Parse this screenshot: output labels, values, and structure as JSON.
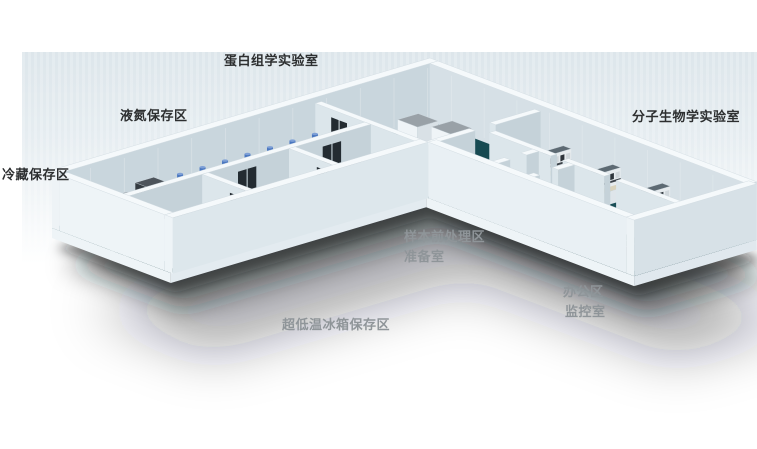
{
  "labels": {
    "proteomics_lab": "蛋白组学实验室",
    "liquid_nitrogen_area": "液氮保存区",
    "cold_storage_area": "冷藏保存区",
    "molecular_biology_lab": "分子生物学实验室",
    "sample_pretreatment_area": "样本前处理区",
    "preparation_room": "准备室",
    "office_area": "办公区",
    "monitoring_room": "监控室",
    "ult_freezer_area": "超低温冰箱保存区"
  },
  "colors": {
    "background": "#ffffff",
    "floor_teal": "#174A52",
    "floor_teal_light": "#1D5058",
    "wall_top": "#F5F9FB",
    "wall_inner_left": "#DCE6EB",
    "wall_inner_right": "#C5D2D9",
    "wall_outer": "#E9F0F4",
    "equipment_top_gray": "#848C93",
    "equipment_body_white": "#EEF3F6",
    "dewar_body": "#E7DFC7",
    "dewar_cap_blue": "#4A77C0",
    "bench_riser_top": "#5D6A73",
    "desk_dark": "#262D33",
    "door_dark": "#232B31",
    "cabinet_tan": "#C89A52",
    "shadow": "#161C21",
    "label_dark": "#2D2F30",
    "label_light": "#8F9599"
  }
}
